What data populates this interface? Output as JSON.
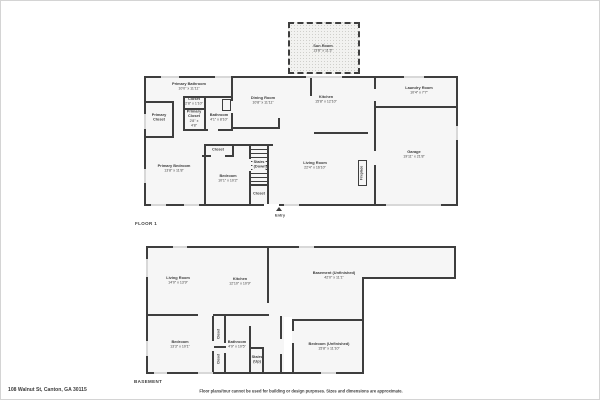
{
  "palette": {
    "wall": "#3e3e3e",
    "window": "#d8d8d8",
    "room_fill": "#f6f6f6",
    "text": "#3c3c3c"
  },
  "footer": {
    "address": "108 Walnut St, Canton, GA 30115",
    "disclaimer": "Floor plans/tour cannot be used for building or design purposes. Sizes and dimensions are approximate."
  },
  "floor1": {
    "label": "FLOOR 1",
    "entry": "Entry",
    "rooms": {
      "sun_room": {
        "name": "Sun Room",
        "dims": "13'8\" x 11'3\""
      },
      "primary_bathroom": {
        "name": "Primary Bathroom",
        "dims": "10'0\" x 11'11\""
      },
      "primary_closet_left": {
        "name": "Primary Closet"
      },
      "closet_small": {
        "name": "Closet",
        "dims": "2'8\" x 1'10\""
      },
      "primary_closet_small": {
        "name": "Primary Closet",
        "dims": "2'8\" x 4'8\""
      },
      "bathroom": {
        "name": "Bathroom",
        "dims": "4'1\" x 8'10\""
      },
      "dining_room": {
        "name": "Dining Room",
        "dims": "10'8\" x 11'11\""
      },
      "kitchen": {
        "name": "Kitchen",
        "dims": "15'8\" x 12'10\""
      },
      "laundry_room": {
        "name": "Laundry Room",
        "dims": "10'4\" x 7'7\""
      },
      "garage": {
        "name": "Garage",
        "dims": "19'11\" x 21'8\""
      },
      "primary_bedroom": {
        "name": "Primary Bedroom",
        "dims": "13'8\" x 11'8\""
      },
      "closet_bedroom": {
        "name": "Closet"
      },
      "bedroom": {
        "name": "Bedroom",
        "dims": "10'1\" x 10'2\""
      },
      "stairs_down": {
        "name": "Stairs (Down)"
      },
      "closet_stairs": {
        "name": "Closet"
      },
      "living_room": {
        "name": "Living Room",
        "dims": "22'4\" x 16'10\""
      },
      "fireplace": {
        "name": "Fireplace"
      }
    }
  },
  "basement": {
    "label": "BASEMENT",
    "rooms": {
      "living_room": {
        "name": "Living Room",
        "dims": "14'0\" x 13'9\""
      },
      "kitchen": {
        "name": "Kitchen",
        "dims": "12'10\" x 10'9\""
      },
      "basement_unfinished": {
        "name": "Basement (Unfinished)",
        "dims": "42'0\" x 11'1\""
      },
      "bedroom": {
        "name": "Bedroom",
        "dims": "13'3\" x 10'1\""
      },
      "closet_a": {
        "name": "Closet"
      },
      "closet_b": {
        "name": "Closet"
      },
      "bathroom": {
        "name": "Bathroom",
        "dims": "4'9\" x 10'5\""
      },
      "stairs_up": {
        "name": "Stairs (Up)"
      },
      "bedroom_unfinished": {
        "name": "Bedroom (Unfinished)",
        "dims": "15'8\" x 11'10\""
      }
    }
  }
}
